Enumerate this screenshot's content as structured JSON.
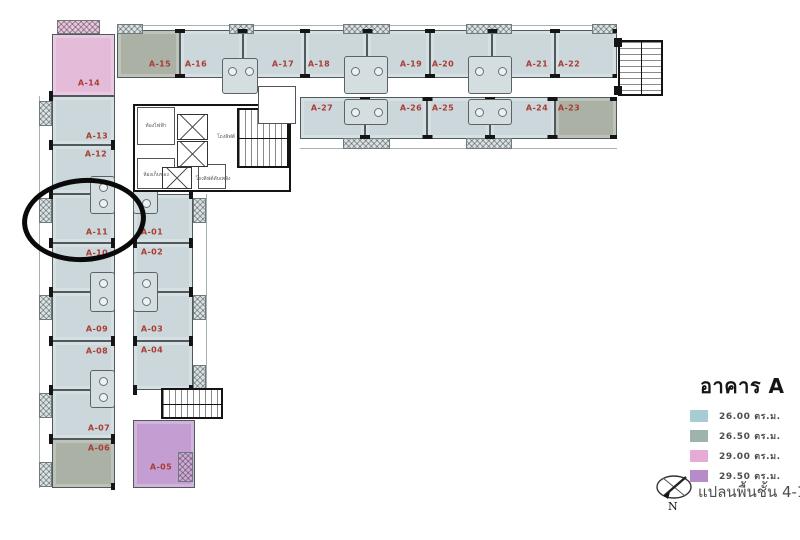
{
  "legend": {
    "title": "อาคาร A",
    "items": [
      {
        "key": "26.00",
        "label": "26.00 ตร.ม.",
        "swatch": "#a7cdd3",
        "fill": "#cbd7da"
      },
      {
        "key": "26.50",
        "label": "26.50 ตร.ม.",
        "swatch": "#9eb3a9",
        "fill": "#abb2a5"
      },
      {
        "key": "29.00",
        "label": "29.00 ตร.ม.",
        "swatch": "#e3abd5",
        "fill": "#e5bbda"
      },
      {
        "key": "29.50",
        "label": "29.50 ตร.ม.",
        "swatch": "#b58bc9",
        "fill": "#c49ed2"
      }
    ]
  },
  "caption": "แปลนพื้นชั้น 4-18",
  "compass": {
    "n_label": "N"
  },
  "plan": {
    "label_color": "#a93c34",
    "highlight": {
      "unit": "A-11",
      "cx": 84,
      "cy": 220,
      "rx": 57,
      "ry": 37
    },
    "units": [
      {
        "id": "A-15",
        "x": 117,
        "y": 30,
        "w": 63,
        "h": 48,
        "size": "26.50",
        "lx": 160,
        "ly": 64
      },
      {
        "id": "A-16",
        "x": 180,
        "y": 30,
        "w": 63,
        "h": 48,
        "size": "26.00",
        "lx": 196,
        "ly": 64
      },
      {
        "id": "A-17",
        "x": 243,
        "y": 30,
        "w": 62,
        "h": 48,
        "size": "26.00",
        "lx": 283,
        "ly": 64
      },
      {
        "id": "A-18",
        "x": 305,
        "y": 30,
        "w": 62,
        "h": 48,
        "size": "26.00",
        "lx": 319,
        "ly": 64
      },
      {
        "id": "A-19",
        "x": 367,
        "y": 30,
        "w": 63,
        "h": 48,
        "size": "26.00",
        "lx": 411,
        "ly": 64
      },
      {
        "id": "A-20",
        "x": 430,
        "y": 30,
        "w": 62,
        "h": 48,
        "size": "26.00",
        "lx": 443,
        "ly": 64
      },
      {
        "id": "A-21",
        "x": 492,
        "y": 30,
        "w": 63,
        "h": 48,
        "size": "26.00",
        "lx": 537,
        "ly": 64
      },
      {
        "id": "A-22",
        "x": 555,
        "y": 30,
        "w": 62,
        "h": 48,
        "size": "26.00",
        "lx": 569,
        "ly": 64
      },
      {
        "id": "A-27",
        "x": 300,
        "y": 97,
        "w": 65,
        "h": 42,
        "size": "26.00",
        "lx": 322,
        "ly": 108
      },
      {
        "id": "A-26",
        "x": 365,
        "y": 97,
        "w": 62,
        "h": 42,
        "size": "26.00",
        "lx": 411,
        "ly": 108
      },
      {
        "id": "A-25",
        "x": 427,
        "y": 97,
        "w": 63,
        "h": 42,
        "size": "26.00",
        "lx": 443,
        "ly": 108
      },
      {
        "id": "A-24",
        "x": 490,
        "y": 97,
        "w": 65,
        "h": 42,
        "size": "26.00",
        "lx": 537,
        "ly": 108
      },
      {
        "id": "A-23",
        "x": 555,
        "y": 97,
        "w": 62,
        "h": 42,
        "size": "26.50",
        "lx": 569,
        "ly": 108
      },
      {
        "id": "A-14",
        "x": 52,
        "y": 34,
        "w": 63,
        "h": 62,
        "size": "29.00",
        "lx": 89,
        "ly": 83
      },
      {
        "id": "A-13",
        "x": 52,
        "y": 96,
        "w": 63,
        "h": 49,
        "size": "26.00",
        "lx": 97,
        "ly": 136
      },
      {
        "id": "A-12",
        "x": 52,
        "y": 145,
        "w": 63,
        "h": 49,
        "size": "26.00",
        "lx": 96,
        "ly": 154
      },
      {
        "id": "A-11",
        "x": 52,
        "y": 194,
        "w": 63,
        "h": 49,
        "size": "26.00",
        "lx": 97,
        "ly": 232
      },
      {
        "id": "A-10",
        "x": 52,
        "y": 243,
        "w": 63,
        "h": 49,
        "size": "26.00",
        "lx": 97,
        "ly": 253
      },
      {
        "id": "A-09",
        "x": 52,
        "y": 292,
        "w": 63,
        "h": 49,
        "size": "26.00",
        "lx": 97,
        "ly": 329
      },
      {
        "id": "A-08",
        "x": 52,
        "y": 341,
        "w": 63,
        "h": 49,
        "size": "26.00",
        "lx": 97,
        "ly": 351
      },
      {
        "id": "A-07",
        "x": 52,
        "y": 390,
        "w": 63,
        "h": 49,
        "size": "26.00",
        "lx": 99,
        "ly": 428
      },
      {
        "id": "A-06",
        "x": 52,
        "y": 439,
        "w": 63,
        "h": 49,
        "size": "26.50",
        "lx": 99,
        "ly": 448
      },
      {
        "id": "A-01",
        "x": 133,
        "y": 194,
        "w": 60,
        "h": 49,
        "size": "26.00",
        "lx": 152,
        "ly": 232
      },
      {
        "id": "A-02",
        "x": 133,
        "y": 243,
        "w": 60,
        "h": 49,
        "size": "26.00",
        "lx": 152,
        "ly": 252
      },
      {
        "id": "A-03",
        "x": 133,
        "y": 292,
        "w": 60,
        "h": 49,
        "size": "26.00",
        "lx": 152,
        "ly": 329
      },
      {
        "id": "A-04",
        "x": 133,
        "y": 341,
        "w": 60,
        "h": 49,
        "size": "26.00",
        "lx": 152,
        "ly": 350
      },
      {
        "id": "A-05",
        "x": 133,
        "y": 420,
        "w": 62,
        "h": 68,
        "size": "29.50",
        "lx": 161,
        "ly": 467
      }
    ],
    "core_labels": [
      {
        "text": "ห้องไฟฟ้า",
        "x": 156,
        "y": 127
      },
      {
        "text": "โถงลิฟต์",
        "x": 226,
        "y": 138
      },
      {
        "text": "ห้องเก็บของ",
        "x": 156,
        "y": 176
      },
      {
        "text": "โถงลิฟต์ดับเพลิง",
        "x": 213,
        "y": 180
      }
    ]
  }
}
